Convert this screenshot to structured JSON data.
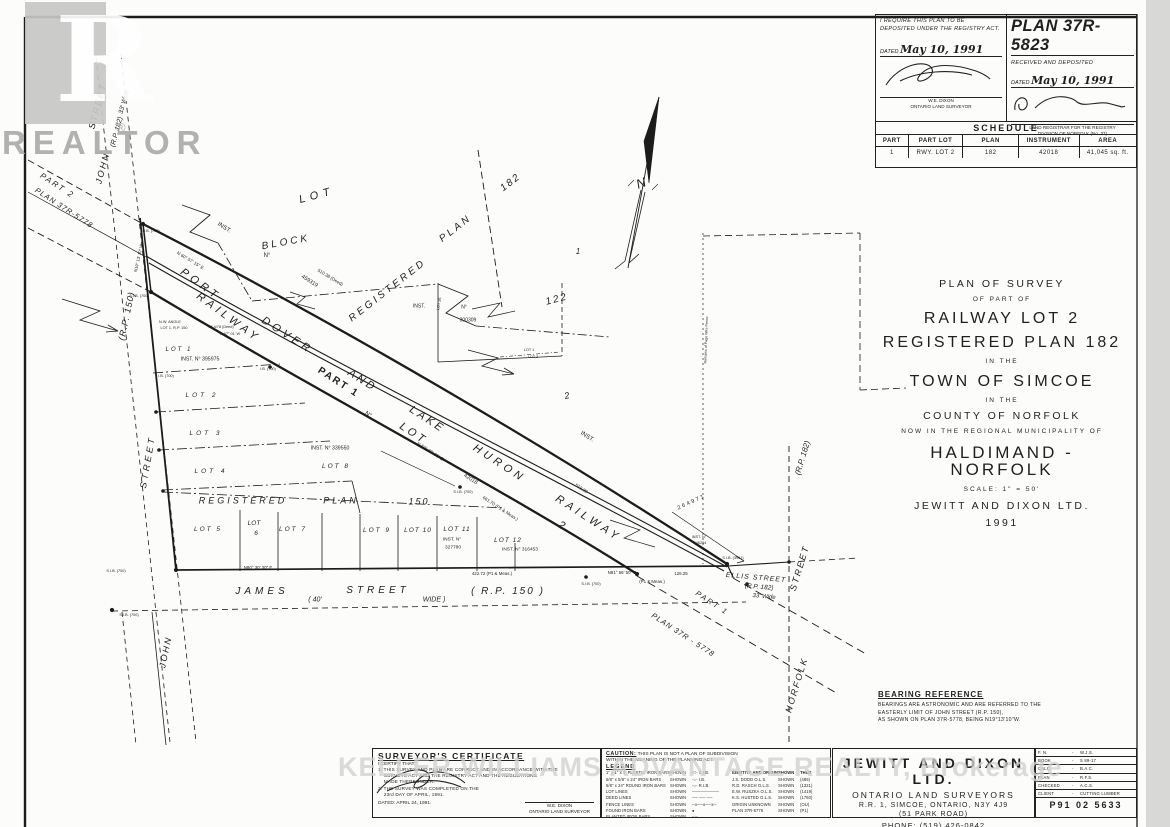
{
  "watermarks": {
    "realtor_letter": "R",
    "realtor_word": "REALTOR",
    "registered_mark": "®",
    "brokerage": "KELLER WILLIAMS ADVANTAGE REALTY, Brokerage"
  },
  "deposit_block": {
    "left": {
      "line1": "I REQUIRE THIS PLAN TO BE",
      "line2": "DEPOSITED UNDER THE REGISTRY ACT.",
      "dated_label": "DATED",
      "dated_value": "May 10, 1991",
      "name": "W.E. DIXON",
      "role": "ONTARIO LAND SURVEYOR"
    },
    "right": {
      "plan_number": "PLAN 37R-5823",
      "received": "RECEIVED AND DEPOSITED",
      "dated_label": "DATED",
      "dated_value": "May 10, 1991",
      "role1": "LAND REGISTRAR FOR THE REGISTRY",
      "role2": "DIVISION OF NORFOLK (No. 37)"
    }
  },
  "schedule": {
    "title": "SCHEDULE",
    "headers": [
      "PART",
      "PART LOT",
      "PLAN",
      "INSTRUMENT",
      "AREA"
    ],
    "rows": [
      [
        "1",
        "RWY. LOT 2",
        "182",
        "42018",
        "41,045 sq. ft."
      ]
    ]
  },
  "survey_title": {
    "lines": [
      {
        "t": "PLAN OF SURVEY",
        "c": "t-md"
      },
      {
        "t": "OF PART OF",
        "c": "t-sm"
      },
      {
        "t": "RAILWAY LOT 2",
        "c": "t-lg"
      },
      {
        "t": "REGISTERED PLAN 182",
        "c": "t-lg"
      },
      {
        "t": "IN THE",
        "c": "t-sm"
      },
      {
        "t": "TOWN OF SIMCOE",
        "c": "t-lg"
      },
      {
        "t": "IN THE",
        "c": "t-sm"
      },
      {
        "t": "COUNTY OF NORFOLK",
        "c": "t-md"
      },
      {
        "t": "NOW IN THE REGIONAL MUNICIPALITY OF",
        "c": "t-sm"
      },
      {
        "t": "HALDIMAND - NORFOLK",
        "c": "t-xl"
      },
      {
        "t": "SCALE: 1\" = 50'",
        "c": "t-sm"
      },
      {
        "t": "JEWITT AND DIXON LTD.",
        "c": "t-md"
      },
      {
        "t": "1991",
        "c": "t-md"
      }
    ]
  },
  "bearing_reference": {
    "title": "BEARING REFERENCE",
    "lines": [
      "BEARINGS ARE ASTRONOMIC AND ARE REFERRED TO THE",
      "EASTERLY LIMIT OF JOHN STREET (R.P. 150),",
      "AS SHOWN ON PLAN 37R-5778, BEING N19°13'10\"W."
    ]
  },
  "certificate": {
    "title": "SURVEYOR'S CERTIFICATE",
    "certify": "I CERTIFY THAT:",
    "lines": [
      "1. THIS SURVEY AND PLAN ARE CORRECT AND IN ACCORDANCE WITH THE",
      "    SURVEYS ACT AND THE REGISTRY ACT AND THE REGULATIONS",
      "    MADE THEREUNDER.",
      "2. THE SURVEY WAS COMPLETED ON THE",
      "    23rd DAY OF APRIL, 1991."
    ],
    "dated": "DATED: APRIL 24, 1991.",
    "name": "W.E. DIXON",
    "role": "ONTARIO LAND SURVEYOR"
  },
  "caution": {
    "label": "CAUTION:",
    "text1": "THIS PLAN IS NOT A PLAN OF SUBDIVISION",
    "text2": "WITHIN THE MEANING OF THE PLANNING ACT.",
    "legend_title": "LEGEND",
    "legend_left": [
      [
        "1\" x 1\" x 4'  PLASTIC IRON BARS",
        "SHOWN",
        "-□- S.I.B."
      ],
      [
        "5/8\" x 5/8\" x 24\"  IRON BARS",
        "SHOWN",
        "-○- I.B."
      ],
      [
        "5/8\" x 24\" ROUND  IRON BARS",
        "SHOWN",
        "-○- R.I.B."
      ],
      [
        "LOT LINES",
        "SHOWN",
        "─────────"
      ],
      [
        "DEED LINES",
        "SHOWN",
        "── ── ──"
      ],
      [
        "FENCE LINES",
        "SHOWN",
        "─x──x──x─"
      ],
      [
        "FOUND IRON BARS",
        "SHOWN",
        "●"
      ],
      [
        "PLANTED IRON BARS",
        "SHOWN",
        "-○-"
      ]
    ],
    "legend_right_header": [
      "IDENTITY AND ORIGIN",
      "SHOWN",
      "THUS"
    ],
    "legend_right": [
      [
        "J.S. DODD O.L.S.",
        "SHOWN",
        "(489)"
      ],
      [
        "R.D. RASCH O.L.S.",
        "SHOWN",
        "(1321)"
      ],
      [
        "E.W. RUSZKA O.L.S.",
        "SHOWN",
        "(1419)"
      ],
      [
        "K.S. HUSTED O.L.S.",
        "SHOWN",
        "(1760)"
      ],
      [
        "ORIGIN UNKNOWN",
        "SHOWN",
        "(OU)"
      ],
      [
        "PLAN 37R-5778",
        "SHOWN",
        "(P1)"
      ]
    ]
  },
  "company": {
    "name": "JEWITT AND DIXON LTD.",
    "sub": "ONTARIO LAND SURVEYORS",
    "addr1": "R.R. 1, SIMCOE, ONTARIO, N3Y 4J9",
    "addr2": "(51 PARK ROAD)",
    "phone": "PHONE: (519) 426-0842"
  },
  "info_table": {
    "rows": [
      [
        "F. N.",
        "W.J.S."
      ],
      [
        "BOOK",
        "S 89-17"
      ],
      [
        "CALC.",
        "B.A.C."
      ],
      [
        "PLAN",
        "R.F.S."
      ],
      [
        "CHECKED",
        "A.C.S."
      ],
      [
        "CLIENT",
        "CUTTING LUMBER"
      ]
    ],
    "job_no": "P91 02 5633"
  },
  "drawing": {
    "labels": [
      {
        "t": "PART 2",
        "x": 57,
        "y": 186,
        "r": 33,
        "s": 8,
        "i": 1,
        "w": 2
      },
      {
        "t": "PLAN 37R-5778",
        "x": 64,
        "y": 208,
        "r": 33,
        "s": 7.5,
        "i": 1,
        "w": 1
      },
      {
        "t": "JOHN",
        "x": 103,
        "y": 168,
        "r": -75,
        "s": 9,
        "i": 1,
        "w": 2
      },
      {
        "t": "STREET",
        "x": 98,
        "y": 106,
        "r": -75,
        "s": 9,
        "i": 1,
        "w": 2
      },
      {
        "t": "(R.P. 182)",
        "x": 117,
        "y": 132,
        "r": -75,
        "s": 7,
        "i": 1
      },
      {
        "t": "33' Wide",
        "x": 125,
        "y": 102,
        "r": -75,
        "s": 6.5,
        "i": 1
      },
      {
        "t": "(R.P. 150)",
        "x": 127,
        "y": 316,
        "r": -78,
        "s": 9,
        "i": 1,
        "w": 1
      },
      {
        "t": "STREET",
        "x": 148,
        "y": 462,
        "r": -80,
        "s": 9,
        "i": 1,
        "w": 3
      },
      {
        "t": "JOHN",
        "x": 166,
        "y": 652,
        "r": -78,
        "s": 9,
        "i": 1,
        "w": 2
      },
      {
        "t": "JAMES",
        "x": 262,
        "y": 592,
        "s": 10,
        "i": 1,
        "w": 4
      },
      {
        "t": "( 40'",
        "x": 315,
        "y": 600,
        "s": 7,
        "i": 1
      },
      {
        "t": "STREET",
        "x": 378,
        "y": 591,
        "s": 10,
        "i": 1,
        "w": 4
      },
      {
        "t": "WIDE )",
        "x": 434,
        "y": 600,
        "s": 7,
        "i": 1
      },
      {
        "t": "( R.P.  150 )",
        "x": 508,
        "y": 592,
        "s": 10,
        "i": 1,
        "w": 2
      },
      {
        "t": "ELLIS  STREET",
        "x": 756,
        "y": 578,
        "r": 5,
        "s": 7,
        "i": 1,
        "w": 1
      },
      {
        "t": "(R.P. 182)",
        "x": 759,
        "y": 588,
        "r": 5,
        "s": 6.5,
        "i": 1
      },
      {
        "t": "33' Wide",
        "x": 764,
        "y": 597,
        "r": 5,
        "s": 6,
        "i": 1
      },
      {
        "t": "PART 1",
        "x": 712,
        "y": 603,
        "r": 33,
        "s": 7.5,
        "i": 1,
        "w": 2
      },
      {
        "t": "PLAN 37R - 5778",
        "x": 683,
        "y": 635,
        "r": 33,
        "s": 7.5,
        "i": 1,
        "w": 1
      },
      {
        "t": "(R.P. 182)",
        "x": 803,
        "y": 458,
        "r": -73,
        "s": 8,
        "i": 1
      },
      {
        "t": "STREET",
        "x": 800,
        "y": 568,
        "r": -73,
        "s": 9,
        "i": 1,
        "w": 2
      },
      {
        "t": "NORFOLK",
        "x": 797,
        "y": 685,
        "r": -73,
        "s": 9,
        "i": 1,
        "w": 2
      },
      {
        "t": "PORT",
        "x": 200,
        "y": 285,
        "r": 36,
        "s": 11,
        "i": 1,
        "w": 4
      },
      {
        "t": "DOVER",
        "x": 287,
        "y": 336,
        "r": 33,
        "s": 11,
        "i": 1,
        "w": 4
      },
      {
        "t": "AND",
        "x": 362,
        "y": 381,
        "r": 33,
        "s": 11,
        "i": 1,
        "w": 3
      },
      {
        "t": "LAKE",
        "x": 427,
        "y": 420,
        "r": 33,
        "s": 11,
        "i": 1,
        "w": 3
      },
      {
        "t": "HURON",
        "x": 499,
        "y": 464,
        "r": 33,
        "s": 11,
        "i": 1,
        "w": 4
      },
      {
        "t": "RAILWAY",
        "x": 588,
        "y": 519,
        "r": 33,
        "s": 11,
        "i": 1,
        "w": 4
      },
      {
        "t": "RAILWAY",
        "x": 228,
        "y": 318,
        "r": 36,
        "s": 11,
        "i": 1,
        "w": 4
      },
      {
        "t": "LOT",
        "x": 413,
        "y": 434,
        "r": 33,
        "s": 11,
        "i": 1,
        "w": 3
      },
      {
        "t": "2",
        "x": 561,
        "y": 526,
        "r": 33,
        "s": 11,
        "i": 1
      },
      {
        "t": "PART  1",
        "x": 338,
        "y": 383,
        "r": 33,
        "s": 10,
        "b": 1,
        "w": 2
      },
      {
        "t": "N°",
        "x": 368,
        "y": 415,
        "r": 33,
        "s": 6
      },
      {
        "t": "42018",
        "x": 470,
        "y": 480,
        "r": 33,
        "s": 5.5
      },
      {
        "t": "N 60° 57' 15\" E",
        "x": 190,
        "y": 261,
        "r": 31,
        "s": 4.5
      },
      {
        "t": "510.38 (Deed)",
        "x": 330,
        "y": 278,
        "r": 31,
        "s": 4.5
      },
      {
        "t": "510.39",
        "x": 581,
        "y": 489,
        "r": 33,
        "s": 4.5
      },
      {
        "t": "661.70 (P1 & Meas.)",
        "x": 500,
        "y": 509,
        "r": 33,
        "s": 4.5
      },
      {
        "t": "N 62° 03' 30\" E",
        "x": 430,
        "y": 452,
        "r": 33,
        "s": 4.5
      },
      {
        "t": "N80° 30' 30\" E",
        "x": 258,
        "y": 568,
        "s": 4.4
      },
      {
        "t": "422.72 (P1 & Meas.)",
        "x": 492,
        "y": 574,
        "s": 4.4
      },
      {
        "t": "N81° 56' 50\" E",
        "x": 622,
        "y": 573,
        "s": 4.4
      },
      {
        "t": "(P1 & Meas.)",
        "x": 652,
        "y": 582,
        "s": 4.4
      },
      {
        "t": "126.25",
        "x": 681,
        "y": 574,
        "s": 4.4
      },
      {
        "t": "N19° 13' 10\" W",
        "x": 139,
        "y": 258,
        "r": -78,
        "s": 4.2
      },
      {
        "t": "N.W. ANGLE",
        "x": 170,
        "y": 323,
        "s": 3.8
      },
      {
        "t": "LOT 1, R.P. 150",
        "x": 174,
        "y": 329,
        "s": 3.8
      },
      {
        "t": "15.4/78 (Deed)",
        "x": 221,
        "y": 328,
        "s": 3.8
      },
      {
        "t": "N 67° 01' W",
        "x": 230,
        "y": 335,
        "s": 3.8
      },
      {
        "t": "LOT",
        "x": 317,
        "y": 196,
        "r": -15,
        "s": 11,
        "i": 1,
        "w": 5
      },
      {
        "t": "BLOCK",
        "x": 286,
        "y": 243,
        "r": -10,
        "s": 10,
        "i": 1,
        "w": 3
      },
      {
        "t": "N°",
        "x": 267,
        "y": 256,
        "s": 6
      },
      {
        "t": "459319",
        "x": 309,
        "y": 282,
        "r": 33,
        "s": 5.5
      },
      {
        "t": "INST.",
        "x": 224,
        "y": 228,
        "r": 33,
        "s": 6
      },
      {
        "t": "REGISTERED",
        "x": 388,
        "y": 291,
        "r": -38,
        "s": 10,
        "i": 1,
        "w": 3
      },
      {
        "t": "PLAN",
        "x": 456,
        "y": 229,
        "r": -38,
        "s": 10,
        "i": 1,
        "w": 3
      },
      {
        "t": "182",
        "x": 511,
        "y": 183,
        "r": -38,
        "s": 10,
        "i": 1,
        "w": 2
      },
      {
        "t": "122",
        "x": 557,
        "y": 300,
        "r": -15,
        "s": 10,
        "i": 1,
        "w": 2
      },
      {
        "t": "1",
        "x": 578,
        "y": 252,
        "s": 8,
        "i": 1
      },
      {
        "t": "2",
        "x": 567,
        "y": 396,
        "r": -15,
        "s": 9,
        "i": 1
      },
      {
        "t": "INST.",
        "x": 587,
        "y": 437,
        "r": 33,
        "s": 6
      },
      {
        "t": "INST.",
        "x": 419,
        "y": 307,
        "s": 5
      },
      {
        "t": "N°",
        "x": 464,
        "y": 308,
        "s": 5
      },
      {
        "t": "300309",
        "x": 468,
        "y": 321,
        "s": 5
      },
      {
        "t": "LOT 1",
        "x": 529,
        "y": 351,
        "s": 3.8
      },
      {
        "t": "LOT 2",
        "x": 533,
        "y": 358,
        "s": 3.8
      },
      {
        "t": "LOT  1",
        "x": 179,
        "y": 350,
        "s": 6,
        "i": 1,
        "w": 2
      },
      {
        "t": "INST. N° 395975",
        "x": 200,
        "y": 360,
        "s": 5.2
      },
      {
        "t": "LOT  2",
        "x": 202,
        "y": 396,
        "s": 6.5,
        "i": 1,
        "w": 3
      },
      {
        "t": "LOT  3",
        "x": 206,
        "y": 434,
        "s": 6.5,
        "i": 1,
        "w": 3
      },
      {
        "t": "LOT  4",
        "x": 211,
        "y": 472,
        "s": 6.5,
        "i": 1,
        "w": 3
      },
      {
        "t": "REGISTERED",
        "x": 243,
        "y": 501,
        "s": 9,
        "i": 1,
        "w": 3
      },
      {
        "t": "PLAN",
        "x": 341,
        "y": 501,
        "s": 9,
        "i": 1,
        "w": 3
      },
      {
        "t": "150",
        "x": 419,
        "y": 502,
        "s": 9,
        "i": 1,
        "w": 2
      },
      {
        "t": "LOT  5",
        "x": 208,
        "y": 530,
        "s": 6.5,
        "i": 1,
        "w": 2
      },
      {
        "t": "LOT",
        "x": 254,
        "y": 524,
        "s": 6.5,
        "i": 1
      },
      {
        "t": "6",
        "x": 256,
        "y": 534,
        "s": 6.5,
        "i": 1
      },
      {
        "t": "LOT  7",
        "x": 293,
        "y": 530,
        "s": 6.5,
        "i": 1,
        "w": 2
      },
      {
        "t": "LOT  8",
        "x": 336,
        "y": 467,
        "s": 6.5,
        "i": 1,
        "w": 2
      },
      {
        "t": "INST.   N°   339550",
        "x": 330,
        "y": 449,
        "s": 5.2
      },
      {
        "t": "LOT  9",
        "x": 377,
        "y": 531,
        "s": 6.5,
        "i": 1,
        "w": 2
      },
      {
        "t": "LOT  10",
        "x": 418,
        "y": 531,
        "s": 6.5,
        "i": 1,
        "w": 1
      },
      {
        "t": "LOT  11",
        "x": 457,
        "y": 530,
        "s": 6.5,
        "i": 1,
        "w": 1
      },
      {
        "t": "INST. N°",
        "x": 452,
        "y": 541,
        "s": 4.8
      },
      {
        "t": "327780",
        "x": 453,
        "y": 549,
        "s": 4.8
      },
      {
        "t": "LOT  12",
        "x": 508,
        "y": 541,
        "s": 6.5,
        "i": 1,
        "w": 1
      },
      {
        "t": "INST.    N°    316453",
        "x": 520,
        "y": 551,
        "s": 4.8
      },
      {
        "t": "264971",
        "x": 692,
        "y": 503,
        "r": -25,
        "s": 5.5,
        "w": 2
      },
      {
        "t": "INST. N°",
        "x": 699,
        "y": 538,
        "s": 3.8
      },
      {
        "t": "246264",
        "x": 700,
        "y": 544,
        "s": 3.8
      },
      {
        "t": "S.I.B. (3961)",
        "x": 733,
        "y": 559,
        "s": 3.8
      },
      {
        "t": "S.I.B. (700)",
        "x": 139,
        "y": 297,
        "s": 3.8
      },
      {
        "t": "S.I.B. (700)",
        "x": 150,
        "y": 232,
        "s": 3.8
      },
      {
        "t": "I.B. (700)",
        "x": 268,
        "y": 370,
        "s": 3.8
      },
      {
        "t": "I.B. (700)",
        "x": 166,
        "y": 377,
        "s": 3.8
      },
      {
        "t": "S.I.B. (700)",
        "x": 116,
        "y": 572,
        "s": 3.8
      },
      {
        "t": "S.I.B. (700)",
        "x": 129,
        "y": 616,
        "s": 3.8
      },
      {
        "t": "S.I.B. (700)",
        "x": 463,
        "y": 493,
        "s": 3.8
      },
      {
        "t": "S.I.B. (700)",
        "x": 591,
        "y": 585,
        "s": 3.8
      },
      {
        "t": "Remains of Page Wire Fence",
        "x": 707,
        "y": 340,
        "r": -88,
        "s": 3.6
      },
      {
        "t": "LOT 35",
        "x": 440,
        "y": 304,
        "r": -80,
        "s": 3.8
      },
      {
        "t": "N",
        "x": 641,
        "y": 183,
        "r": -20,
        "s": 13,
        "i": 1
      }
    ]
  }
}
